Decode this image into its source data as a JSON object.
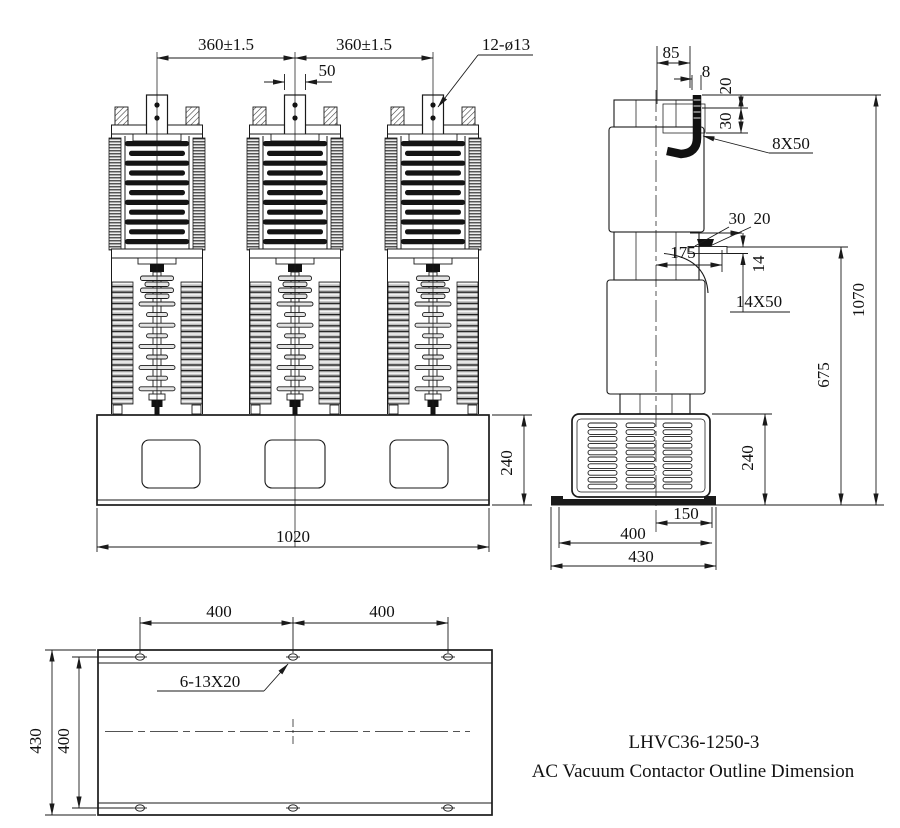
{
  "title": {
    "model": "LHVC36-1250-3",
    "caption": "AC Vacuum Contactor Outline Dimension"
  },
  "front": {
    "span_left": "360±1.5",
    "span_right": "360±1.5",
    "terminal_width": "50",
    "hole_callout": "12-ø13",
    "base_height": "240",
    "base_width": "1020"
  },
  "side": {
    "offset_85": "85",
    "hook_width": "8",
    "hook_step_20": "20",
    "hook_depth_30": "30",
    "hook_note": "8X50",
    "pad_30": "30",
    "pad_20": "20",
    "terminal_reach": "175",
    "busbar_thickness": "14",
    "busbar_note": "14X50",
    "height_total": "1070",
    "height_lower_terminal": "675",
    "box_height": "240",
    "foot_center": "150",
    "foot_holes": "400",
    "foot_width": "430"
  },
  "plan": {
    "span_left": "400",
    "span_right": "400",
    "hole_callout": "6-13X20",
    "depth": "430",
    "hole_rows": "400"
  }
}
